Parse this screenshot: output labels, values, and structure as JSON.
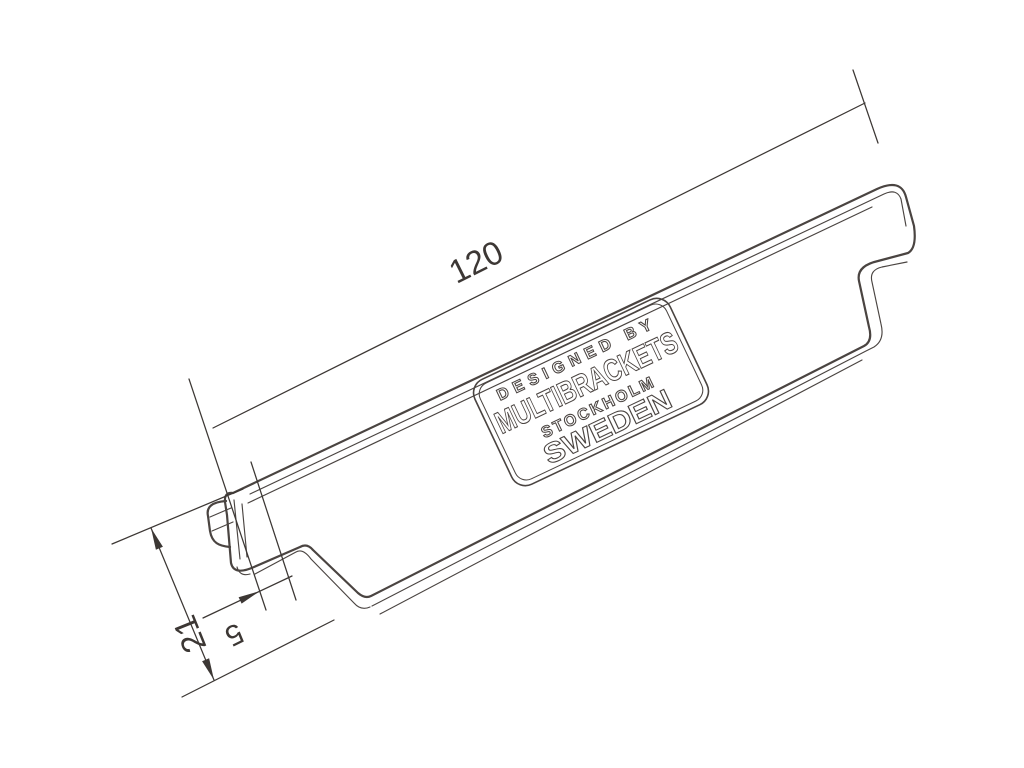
{
  "drawing": {
    "dimensions": {
      "length": {
        "value": "120"
      },
      "width": {
        "value": "21"
      },
      "step": {
        "value": "5"
      }
    },
    "logo_plate": {
      "line1": "DESIGNED BY",
      "line2": "MULTIBRACKETS",
      "line3": "STOCKHOLM",
      "line4": "SWEDEN"
    },
    "colors": {
      "line": "#4a4441",
      "text": "#3c3734",
      "background": "#ffffff"
    }
  }
}
